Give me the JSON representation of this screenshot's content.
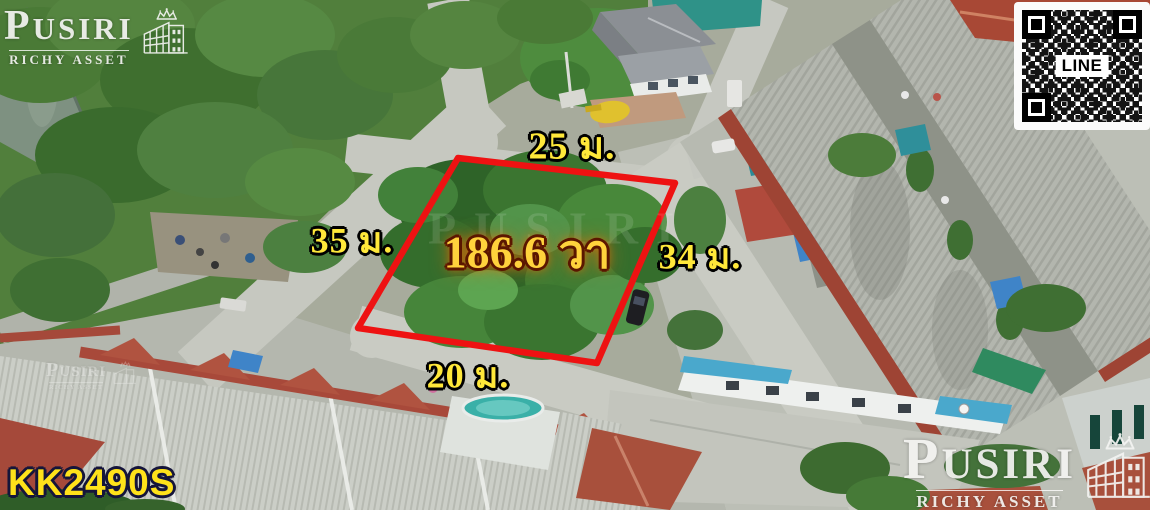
{
  "branding": {
    "logo": {
      "name": "PUSIRI",
      "subtitle": "RICHY ASSET"
    },
    "watermark": "PUSIRI"
  },
  "qr": {
    "label": "LINE"
  },
  "listing": {
    "code": "KK2490S"
  },
  "plot": {
    "area": "186.6 วา",
    "dimensions": {
      "top": "25 ม.",
      "left": "35 ม.",
      "right": "34 ม.",
      "bottom": "20 ม."
    }
  },
  "colors": {
    "plot_outline": "#ee1212",
    "dimension_text": "#ffe83a",
    "area_text": "#ffd23c",
    "area_glow": "#ff6a00",
    "code_text": "#ffe21a"
  }
}
